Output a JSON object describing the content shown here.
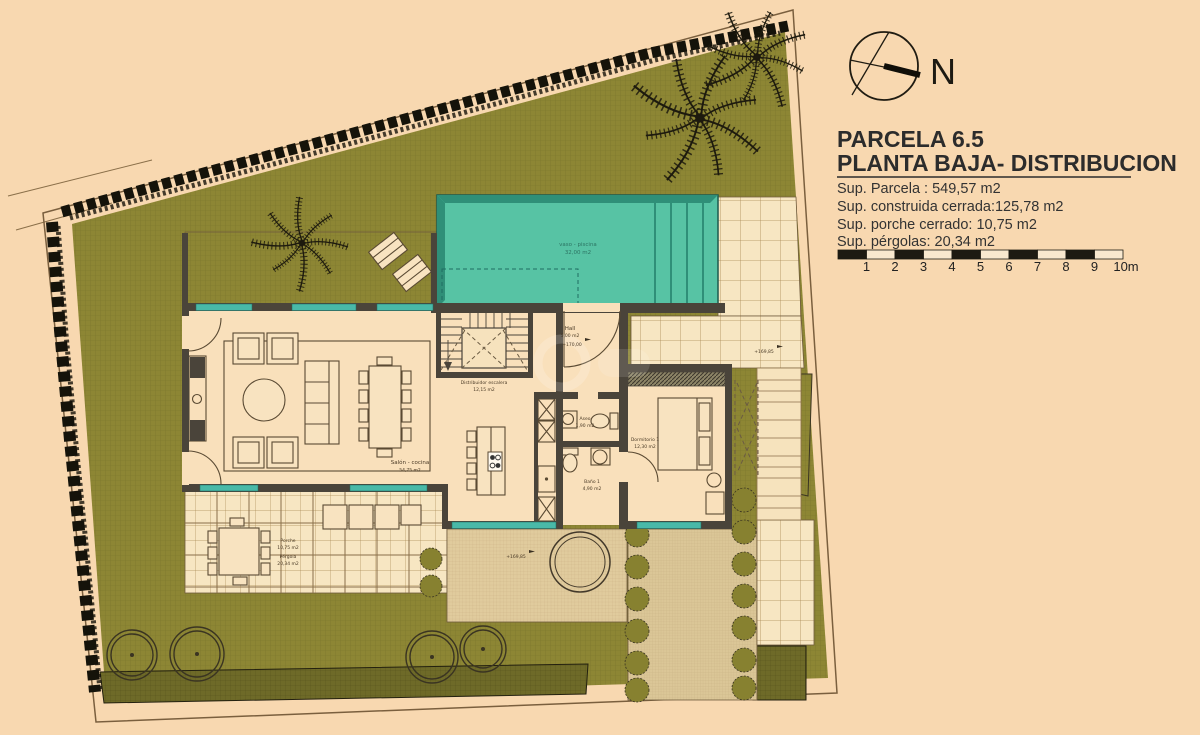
{
  "colors": {
    "background": "#f8d8b0",
    "garden": "#8d8634",
    "pool": "#57c3a4",
    "walls": "#4a443a",
    "window_glass": "#49b9a8",
    "tile": "#f7e6c2"
  },
  "title_block": {
    "parcel_title": "PARCELA 6.5",
    "plan_title": "PLANTA BAJA- DISTRIBUCION",
    "area_lines": [
      "Sup. Parcela : 549,57 m2",
      "Sup. construida cerrada:125,78 m2",
      "Sup. porche cerrado: 10,75 m2",
      "Sup. pérgolas: 20,34 m2"
    ],
    "north_label": "N",
    "scale_ticks": [
      "1",
      "2",
      "3",
      "4",
      "5",
      "6",
      "7",
      "8",
      "9",
      "10m"
    ]
  },
  "plan_labels": {
    "pool": {
      "name": "vaso - piscina",
      "area": "32,00 m2"
    },
    "salon": {
      "name": "Salón - cocina",
      "area": "54,75 m2"
    },
    "distribuidor": {
      "name": "Distribuidor escalera",
      "area": "12,15 m2"
    },
    "hall": {
      "name": "Hall",
      "area": "5,00 m2",
      "level": "+170,00"
    },
    "aseo": {
      "name": "Aseo",
      "area": "1,90 m2"
    },
    "bano": {
      "name": "Baño 1",
      "area": "4,90 m2"
    },
    "dormitorio": {
      "name": "Dormitorio 1",
      "area": "12,30 m2"
    },
    "porche": {
      "name": "Porche",
      "area": "10,75 m2"
    },
    "pergola": {
      "name": "Pérgola",
      "area": "20,34 m2"
    },
    "level_camino": "+169,85",
    "level_terraza": "+169,85"
  }
}
